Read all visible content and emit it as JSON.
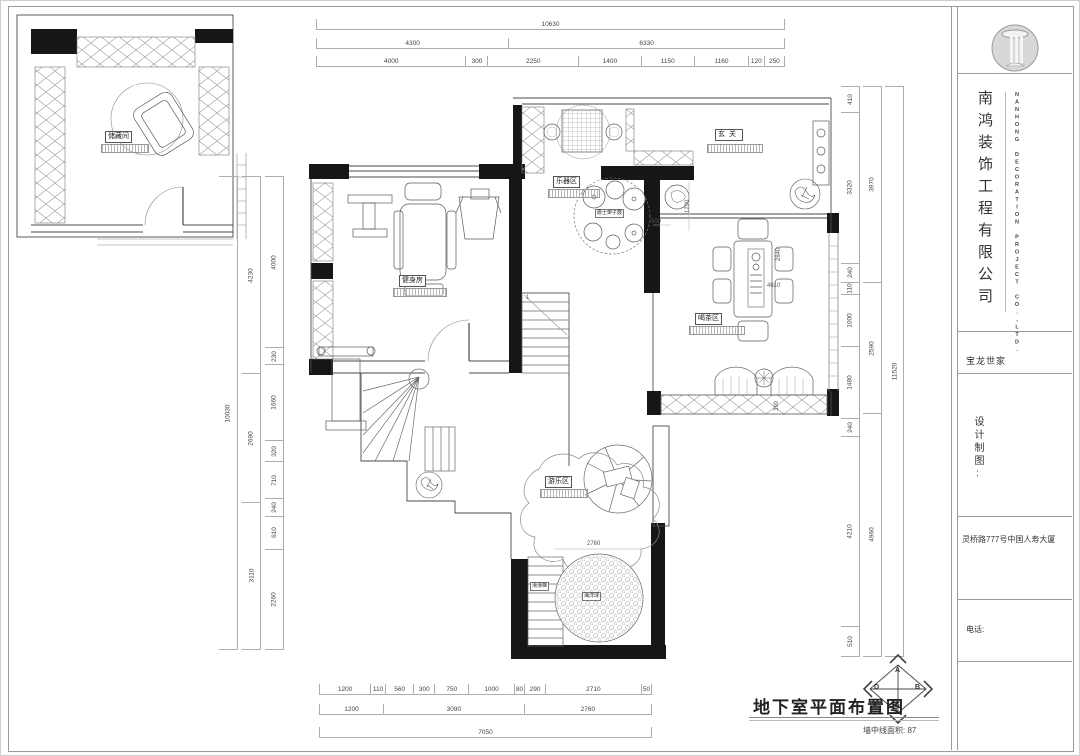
{
  "title_block": {
    "company_cn": "南鸿装饰工程有限公司",
    "company_en": "NANHONG DECORATION PROJECT CO.,LTD.",
    "project": "宝龙世家",
    "drafting": "设计制图:",
    "address": "灵桥路777号中国人寿大厦",
    "phone": "电话:"
  },
  "drawing": {
    "title": "地下室平面布置图",
    "area_note": "墙中线面积: 87",
    "compass": {
      "top": "A",
      "right": "B",
      "bottom": "C",
      "left": "D"
    }
  },
  "rooms": {
    "storage": "储藏间",
    "gym": "健身房",
    "music": "乐器区",
    "foyer": "玄关",
    "tea": "喝茶区",
    "play": "游乐区",
    "ball_pit": "海洋球",
    "slide": "滑滑梯",
    "drums": "爵士架子鼓"
  },
  "dims": {
    "top": [
      [
        "10630"
      ],
      [
        "4300",
        "6330"
      ],
      [
        "4000",
        "300",
        "2250",
        "1400",
        "1150",
        "1160",
        "120",
        "250"
      ]
    ],
    "bottom": [
      [
        "1200",
        "110",
        "560",
        "300",
        "750",
        "1000",
        "80",
        "290",
        "2710",
        "50"
      ],
      [
        "1200",
        "3090",
        "2760"
      ],
      [
        "7050"
      ]
    ],
    "left_outer": [
      "10030"
    ],
    "left_mid": [
      "4230",
      "2690",
      "3110"
    ],
    "left_inner": [
      "4000",
      "230",
      "1660",
      "320",
      "710",
      "240",
      "610",
      "2260"
    ],
    "right_inner": [
      "410",
      "3320",
      "240",
      "110",
      "1000",
      "1480",
      "240",
      "4210",
      "510"
    ],
    "right_mid": [
      "3970",
      "2590",
      "4960"
    ],
    "right_outer": [
      "11520"
    ],
    "in_plan": {
      "stair_number": "1",
      "drum_offset": "1220",
      "cabinet_width": "500",
      "tea_table_width": "2840",
      "tea_table_length": "4610",
      "tea_cabinet_depth": "390",
      "ball_pit_dia": "2760"
    }
  }
}
